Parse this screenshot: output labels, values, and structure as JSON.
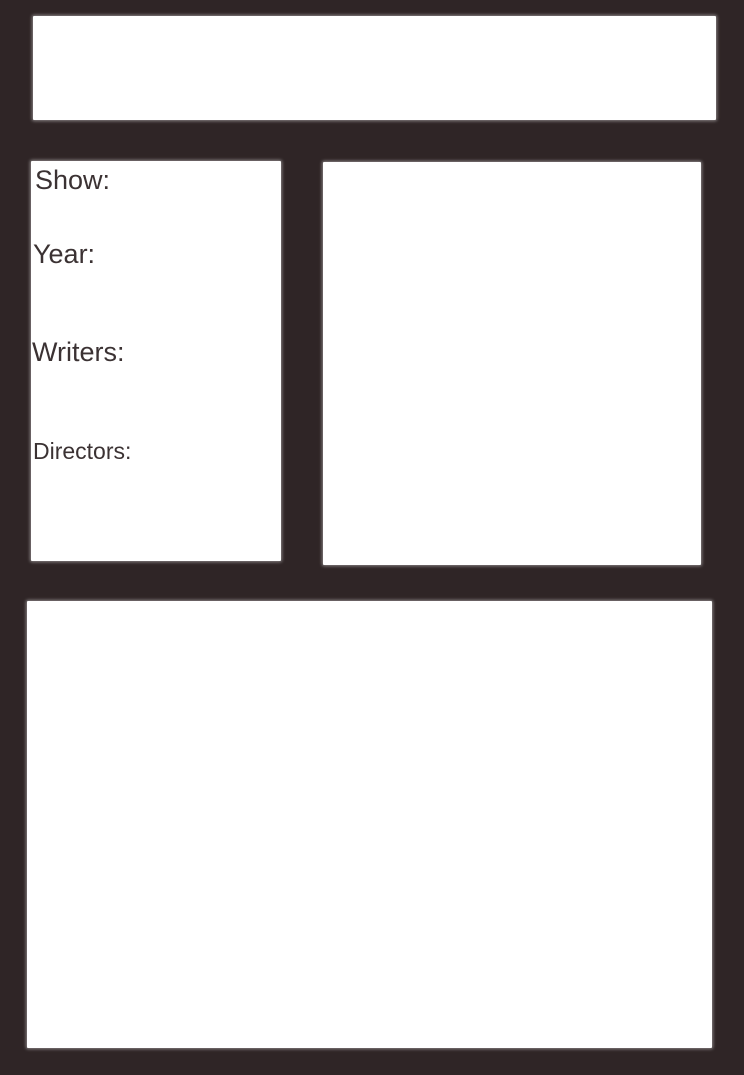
{
  "colors": {
    "background": "#2f2526",
    "panel": "#ffffff",
    "label_text": "#3b3233"
  },
  "header_box": {
    "text": ""
  },
  "info_panel": {
    "labels": [
      {
        "id": "show",
        "text": "Show:"
      },
      {
        "id": "year",
        "text": "Year:"
      },
      {
        "id": "writers",
        "text": "Writers:"
      },
      {
        "id": "directors",
        "text": "Directors:"
      }
    ]
  },
  "image_box": {
    "text": ""
  },
  "content_box": {
    "text": ""
  }
}
